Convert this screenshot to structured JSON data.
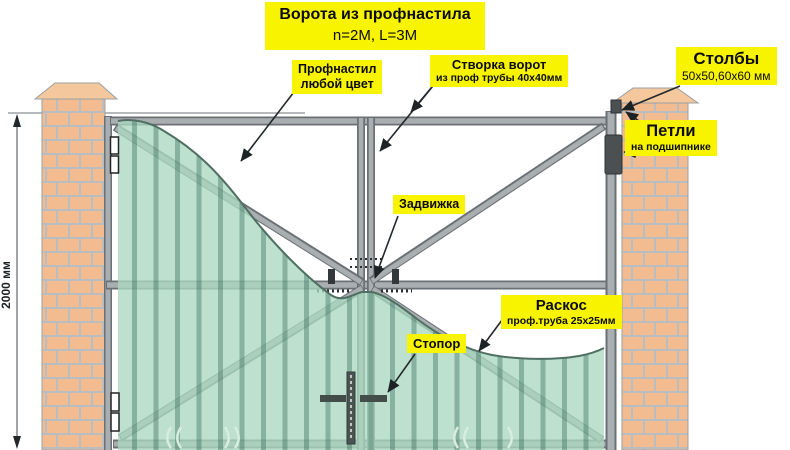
{
  "title": {
    "line1": "Ворота из профнастила",
    "line2": "n=2M, L=3M"
  },
  "dimension": {
    "height_label": "2000 мм"
  },
  "labels": {
    "profnastil": {
      "line1": "Профнастил",
      "line2": "любой цвет"
    },
    "stvorka": {
      "line1": "Створка ворот",
      "line2": "из проф трубы 40x40мм"
    },
    "stolby": {
      "line1": "Столбы",
      "line2": "50x50,60x60 мм"
    },
    "petli": {
      "line1": "Петли",
      "line2": "на подшипнике"
    },
    "zadvizhka": {
      "text": "Задвижка"
    },
    "raskos": {
      "line1": "Раскос",
      "line2": "проф.труба 25x25мм"
    },
    "stopor": {
      "text": "Стопор"
    }
  },
  "colors": {
    "label_yellow": "#f8f400",
    "brick": "#f2bc90",
    "mortar": "#b7bdc1",
    "frame_gray": "#a9aeb1",
    "frame_edge": "#6a7074",
    "sheet_green": "#aad8c0",
    "sheet_rib": "#2f6355",
    "arrow_black": "#1d2225"
  }
}
